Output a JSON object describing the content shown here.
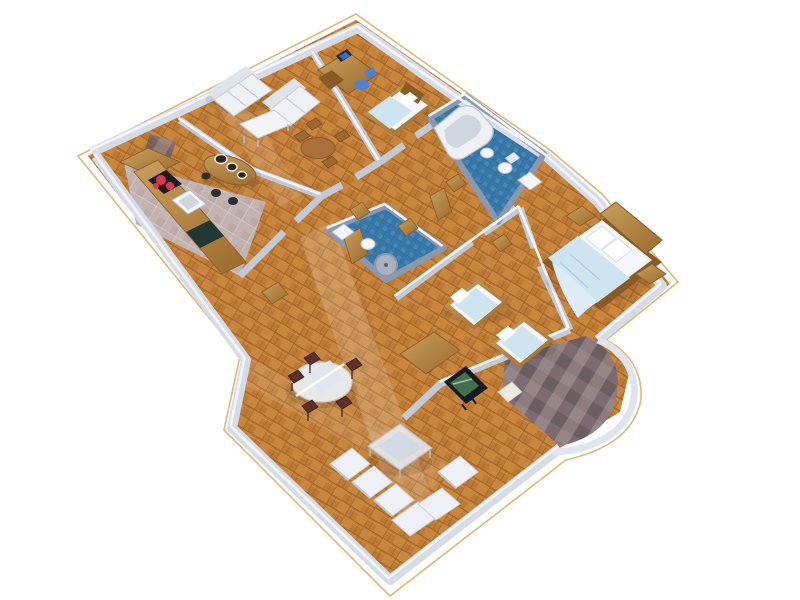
{
  "scene": {
    "title": "3D rendered apartment floor plan, isometric bird's-eye view on white background",
    "render_style": "perspective axonometric architectural render",
    "background": "#ffffff"
  },
  "palette": {
    "slab_outline": "#dcb877",
    "parquet": "#c8863e",
    "parquet_dark": "#a16327",
    "parquet_light": "#e0a45c",
    "kitchen_tile": "#c3b3b1",
    "kitchen_grout": "#d7cbc9",
    "bath_tile": "#3878a8",
    "bath_tile_dark": "#2c699a",
    "wall_light": "#d9dee8",
    "wall_mid": "#c2cad7",
    "wall_dark": "#97a2b6",
    "wall_top": "#f3f5f9",
    "bath_wall": "#8b99b0",
    "stone": "#837476",
    "wood": "#b07b3a",
    "wood_dark": "#8a5a26",
    "white_furniture": "#eff1f5",
    "furniture_shade": "#d3d8e1",
    "bedding_blue": "#cfe4f1",
    "mattress_white": "#f4f6f9",
    "glass": "#e4e9f1",
    "chair_dark": "#5e3028",
    "tv_black": "#181a20",
    "tv_screen": "#42704f",
    "monitor_screen": "#2f6cd8",
    "office_chair_blue": "#5080d0",
    "burner_red": "#e03550",
    "cabinet_green": "#203832"
  },
  "rooms": [
    {
      "id": "living-room",
      "name": "living room",
      "floor": "parquet",
      "furniture": [
        "3-seat white sofa",
        "2-seat white sofa",
        "white coffee table",
        "round wooden dining table",
        "4 wooden chairs"
      ]
    },
    {
      "id": "kitchen",
      "name": "kitchen",
      "floor": "pink-grey tile",
      "furniture": [
        "L-shaped wood counter",
        "cooktop with red burners",
        "sink",
        "oval bar island with bowls",
        "bar stools",
        "dark green cabinet",
        "stone niche"
      ]
    },
    {
      "id": "study-bedroom",
      "name": "study / guest bedroom",
      "floor": "parquet",
      "furniture": [
        "curved wooden desk",
        "computer monitor",
        "blue office chair",
        "single bed with blue blanket"
      ]
    },
    {
      "id": "main-bathroom",
      "name": "main bathroom",
      "floor": "blue tile",
      "furniture": [
        "corner bathtub",
        "bidet",
        "toilet",
        "washbasin"
      ]
    },
    {
      "id": "master-bedroom",
      "name": "master bedroom",
      "floor": "parquet",
      "furniture": [
        "double bed with wood headboard",
        "two nightstands",
        "light blue throw blanket"
      ]
    },
    {
      "id": "small-bathroom",
      "name": "small bathroom",
      "floor": "blue tile",
      "furniture": [
        "washbasin",
        "toilet",
        "round shower tray"
      ]
    },
    {
      "id": "kids-bedroom",
      "name": "twin bedroom",
      "floor": "parquet",
      "furniture": [
        "two single beds with blue bedding"
      ]
    },
    {
      "id": "living-dining",
      "name": "living / dining room",
      "floor": "parquet",
      "furniture": [
        "round glass dining table",
        "5 dark wood chairs",
        "square glass coffee table",
        "white corner sofa",
        "white lounge chair",
        "wood TV sideboard",
        "flat-screen TV"
      ]
    },
    {
      "id": "hallway",
      "name": "hallway",
      "floor": "parquet",
      "furniture": [
        "open wooden doors",
        "wood wardrobe panels"
      ]
    },
    {
      "id": "terrace",
      "name": "terrace",
      "floor": "slate stone",
      "furniture": [
        "rounded white parapet wall"
      ]
    }
  ]
}
